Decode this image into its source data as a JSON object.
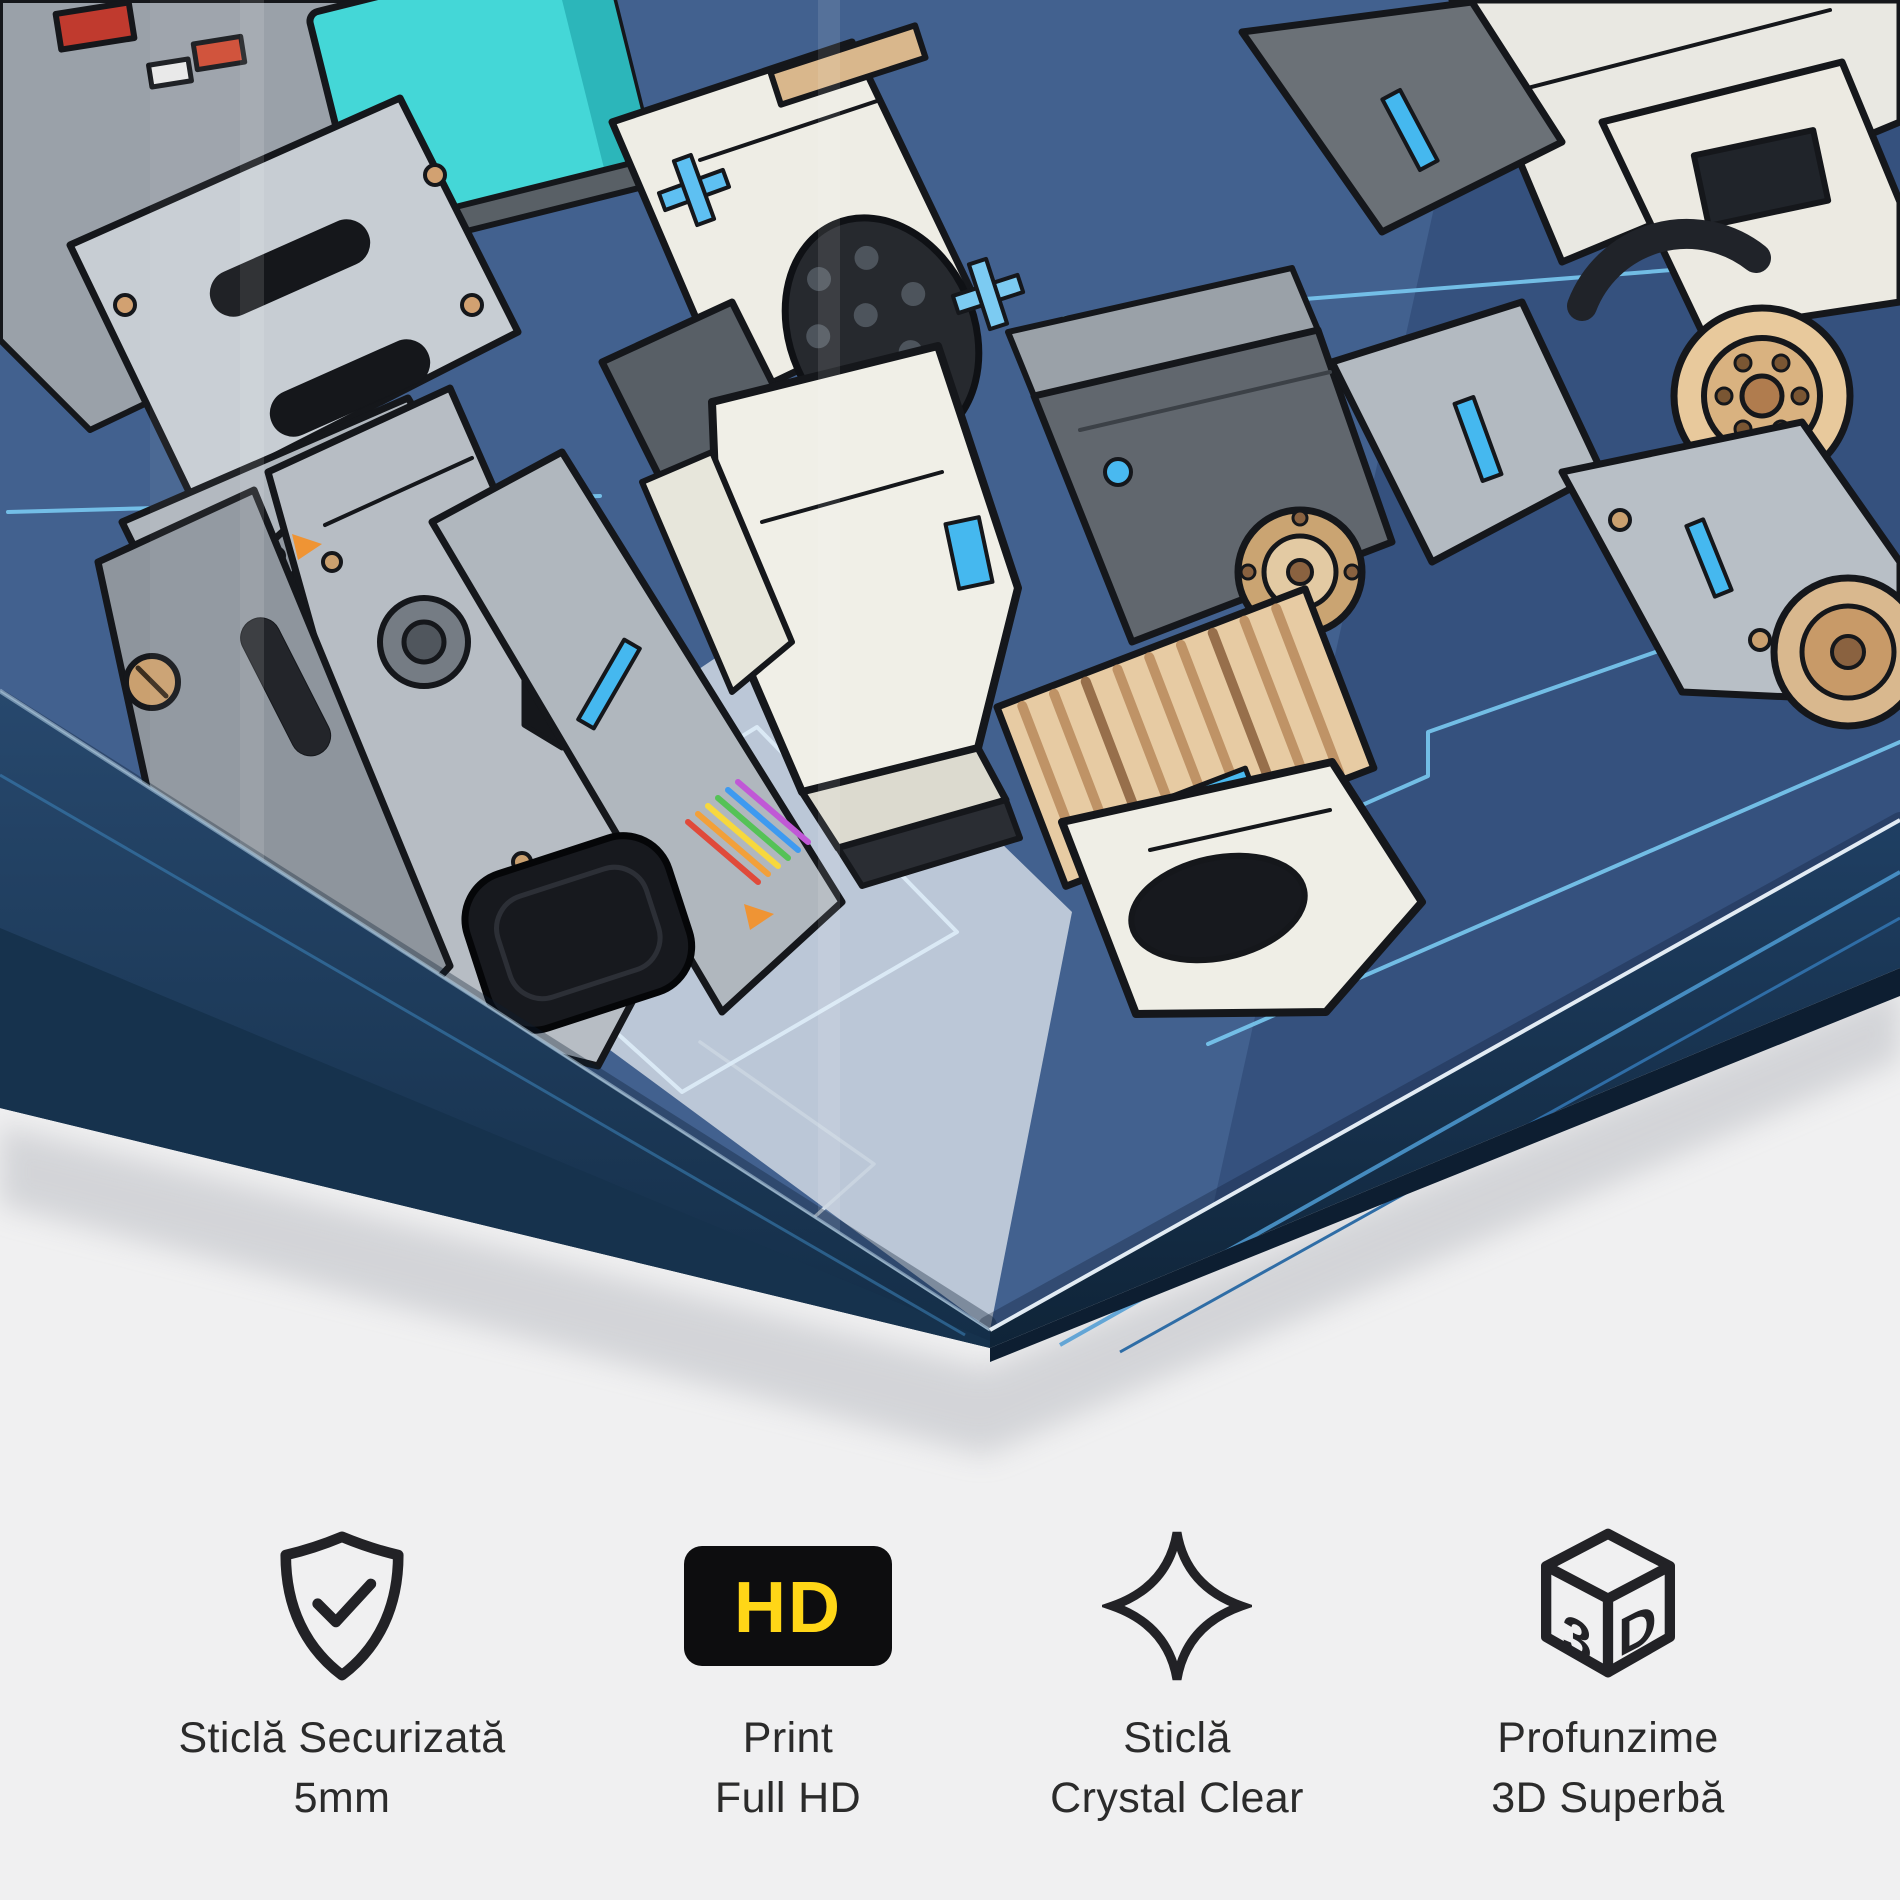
{
  "background_color": "#f0f0f1",
  "panel": {
    "artwork_alt": "Comic-style sci-fi mecha robots illustration printed on an angled tempered-glass panel",
    "art_palette": {
      "background_blue": "#42618f",
      "deep_navy_edge": "#16324d",
      "circuit_cyan": "#79c9f1",
      "accent_cyan": "#45b8ef",
      "panel_gray": "#b7bdc4",
      "ivory": "#f0efe7",
      "beige": "#e7cba3",
      "copper": "#caa472",
      "screen_teal": "#44d7d7",
      "outline_ink": "#15171b"
    }
  },
  "text_color": "#2b2b2b",
  "features": [
    {
      "icon": "shield-check-icon",
      "lines": [
        "Sticlă Securizată",
        "5mm"
      ]
    },
    {
      "icon": "hd-badge-icon",
      "badge_text": "HD",
      "badge_bg": "#0d0d0f",
      "badge_text_color": "#ffd617",
      "lines": [
        "Print",
        "Full HD"
      ]
    },
    {
      "icon": "sparkle-icon",
      "lines": [
        "Sticlă",
        "Crystal Clear"
      ]
    },
    {
      "icon": "cube-3d-icon",
      "cube_left": "3",
      "cube_right": "D",
      "lines": [
        "Profunzime",
        "3D Superbă"
      ]
    }
  ]
}
